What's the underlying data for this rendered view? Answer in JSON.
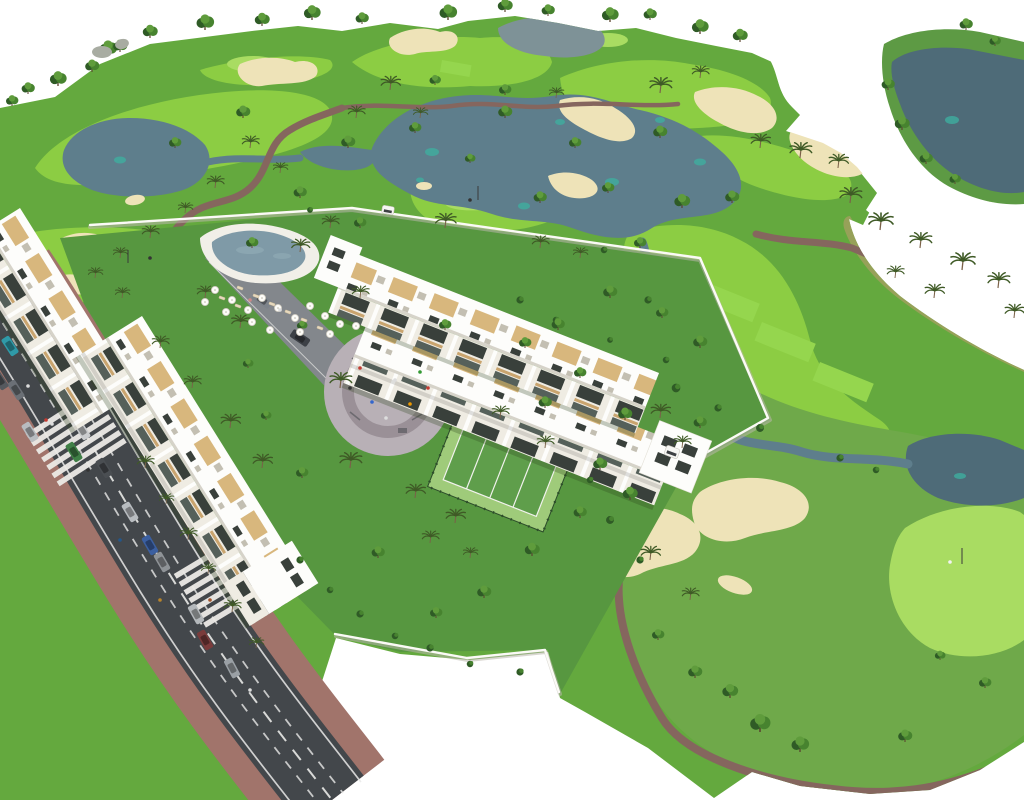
{
  "palette": {
    "bg": "#ffffff",
    "rough": "#64a93e",
    "fringe": "#5d9a44",
    "fairway": "#8ccd43",
    "fairwayMuted": "#6fa94a",
    "green": "#a9dc62",
    "tee": "#95d64e",
    "lake": "#5e7e8c",
    "lakeDark": "#4e6b78",
    "pond": "#7e9297",
    "lakeSpot": "#3fae9f",
    "bunker": "#eee3b8",
    "path": "#85665e",
    "scrub": "#97a159",
    "scrubSpeckle": "#cbca7a",
    "scrubSpeckleDark": "#7e8c4e",
    "lawn": "#579740",
    "building": "#fdfdfb",
    "facade": "#efece3",
    "window": "#39403b",
    "windowLow": "#55605a",
    "wood": "#c9a46e",
    "pergola": "#d8b77d",
    "parapet": "#d6d3c9",
    "roofGray": "#c3bfb2",
    "road": "#43474b",
    "roadLine": "#e9e9e7",
    "sidewalk": "#a1746b",
    "plaza": "#b8b0b6",
    "plazaRing": "#9a9097",
    "pool": "#7f9aa7",
    "poolDeck": "#f1efe8",
    "court": "#9fcb7a",
    "courtIn": "#5f9e4b",
    "courtFence": "#2c4c2a",
    "wall": "#fbfaf6",
    "wallShadow": "#b9b6ac",
    "treeDark": "#2f5b26",
    "treeMid": "#47832f",
    "treeLight": "#5f9c3c",
    "trunk": "#5b4630",
    "palmLeaf": "#3f5a26",
    "palmTrunk": "#7a6148",
    "rock": "#a8aca2",
    "shadow": "#2c4218",
    "driveway": "#83878c",
    "cartWhite": "#f6f6f3"
  },
  "scene": {
    "trees": [
      [
        108,
        56,
        1
      ],
      [
        150,
        38,
        0.85
      ],
      [
        205,
        30,
        1
      ],
      [
        262,
        26,
        0.85
      ],
      [
        312,
        20,
        0.95
      ],
      [
        362,
        24,
        0.75
      ],
      [
        448,
        20,
        1
      ],
      [
        505,
        12,
        0.85
      ],
      [
        548,
        16,
        0.75
      ],
      [
        610,
        22,
        0.95
      ],
      [
        650,
        20,
        0.75
      ],
      [
        700,
        34,
        0.95
      ],
      [
        740,
        42,
        0.85
      ],
      [
        92,
        72,
        0.8
      ],
      [
        58,
        86,
        0.95
      ],
      [
        28,
        94,
        0.75
      ],
      [
        12,
        106,
        0.7
      ],
      [
        120,
        52,
        0.8
      ],
      [
        243,
        118,
        0.8
      ],
      [
        175,
        148,
        0.7
      ],
      [
        348,
        148,
        0.8
      ],
      [
        415,
        133,
        0.7
      ],
      [
        505,
        118,
        0.8
      ],
      [
        575,
        148,
        0.7
      ],
      [
        660,
        138,
        0.8
      ],
      [
        608,
        193,
        0.7
      ],
      [
        540,
        203,
        0.75
      ],
      [
        470,
        163,
        0.6
      ],
      [
        300,
        198,
        0.75
      ],
      [
        360,
        228,
        0.7
      ],
      [
        252,
        248,
        0.7
      ],
      [
        682,
        208,
        0.9
      ],
      [
        732,
        203,
        0.8
      ],
      [
        640,
        248,
        0.7
      ],
      [
        610,
        298,
        0.8
      ],
      [
        662,
        318,
        0.7
      ],
      [
        700,
        348,
        0.8
      ],
      [
        580,
        378,
        0.7
      ],
      [
        545,
        408,
        0.75
      ],
      [
        625,
        420,
        0.8
      ],
      [
        505,
        95,
        0.7
      ],
      [
        435,
        85,
        0.65
      ],
      [
        888,
        90,
        0.75
      ],
      [
        902,
        130,
        0.85
      ],
      [
        926,
        164,
        0.75
      ],
      [
        955,
        184,
        0.65
      ],
      [
        966,
        30,
        0.75
      ],
      [
        995,
        46,
        0.65
      ],
      [
        760,
        732,
        1.15
      ],
      [
        800,
        752,
        1
      ],
      [
        730,
        698,
        0.9
      ],
      [
        695,
        678,
        0.8
      ],
      [
        905,
        742,
        0.8
      ],
      [
        658,
        640,
        0.7
      ],
      [
        985,
        688,
        0.7
      ],
      [
        940,
        660,
        0.6
      ],
      [
        600,
        470,
        0.8
      ],
      [
        630,
        500,
        0.85
      ],
      [
        580,
        518,
        0.75
      ],
      [
        532,
        556,
        0.85
      ],
      [
        484,
        598,
        0.8
      ],
      [
        436,
        618,
        0.7
      ],
      [
        378,
        558,
        0.75
      ],
      [
        302,
        478,
        0.7
      ],
      [
        266,
        420,
        0.6
      ],
      [
        700,
        428,
        0.75
      ],
      [
        525,
        348,
        0.7
      ],
      [
        558,
        330,
        0.75
      ],
      [
        445,
        330,
        0.7
      ],
      [
        302,
        330,
        0.6
      ],
      [
        248,
        368,
        0.6
      ]
    ],
    "palms": [
      [
        390,
        90,
        0.8
      ],
      [
        356,
        118,
        0.7
      ],
      [
        420,
        118,
        0.6
      ],
      [
        660,
        93,
        0.9
      ],
      [
        700,
        78,
        0.7
      ],
      [
        556,
        98,
        0.6
      ],
      [
        760,
        148,
        0.8
      ],
      [
        800,
        158,
        0.9
      ],
      [
        838,
        168,
        0.8
      ],
      [
        850,
        203,
        0.9
      ],
      [
        250,
        148,
        0.7
      ],
      [
        280,
        173,
        0.6
      ],
      [
        215,
        188,
        0.7
      ],
      [
        185,
        213,
        0.6
      ],
      [
        150,
        238,
        0.7
      ],
      [
        120,
        258,
        0.6
      ],
      [
        95,
        278,
        0.6
      ],
      [
        540,
        248,
        0.7
      ],
      [
        580,
        258,
        0.6
      ],
      [
        880,
        230,
        1
      ],
      [
        920,
        248,
        0.9
      ],
      [
        962,
        270,
        1
      ],
      [
        998,
        288,
        0.9
      ],
      [
        1014,
        318,
        0.8
      ],
      [
        934,
        298,
        0.8
      ],
      [
        895,
        278,
        0.7
      ],
      [
        340,
        388,
        0.9
      ],
      [
        350,
        468,
        0.9
      ],
      [
        415,
        498,
        0.8
      ],
      [
        455,
        523,
        0.8
      ],
      [
        500,
        418,
        0.7
      ],
      [
        545,
        448,
        0.7
      ],
      [
        230,
        428,
        0.8
      ],
      [
        262,
        468,
        0.8
      ],
      [
        160,
        348,
        0.7
      ],
      [
        192,
        388,
        0.7
      ],
      [
        122,
        298,
        0.6
      ],
      [
        430,
        543,
        0.7
      ],
      [
        470,
        558,
        0.6
      ],
      [
        660,
        418,
        0.8
      ],
      [
        682,
        448,
        0.7
      ],
      [
        145,
        468,
        0.7
      ],
      [
        166,
        504,
        0.6
      ],
      [
        188,
        540,
        0.7
      ],
      [
        208,
        574,
        0.6
      ],
      [
        232,
        612,
        0.7
      ],
      [
        256,
        648,
        0.6
      ],
      [
        445,
        228,
        0.85
      ],
      [
        300,
        252,
        0.75
      ],
      [
        360,
        298,
        0.7
      ],
      [
        205,
        298,
        0.7
      ],
      [
        240,
        328,
        0.75
      ],
      [
        330,
        228,
        0.7
      ],
      [
        650,
        560,
        0.8
      ],
      [
        690,
        600,
        0.7
      ]
    ],
    "bushes": [
      [
        648,
        300,
        1
      ],
      [
        676,
        388,
        1.2
      ],
      [
        718,
        408,
        1
      ],
      [
        760,
        428,
        1.1
      ],
      [
        840,
        458,
        1
      ],
      [
        876,
        470,
        0.9
      ],
      [
        604,
        250,
        0.9
      ],
      [
        310,
        210,
        0.8
      ],
      [
        520,
        300,
        1
      ],
      [
        556,
        320,
        0.9
      ],
      [
        610,
        340,
        0.8
      ],
      [
        666,
        360,
        0.9
      ],
      [
        300,
        560,
        1
      ],
      [
        330,
        590,
        0.9
      ],
      [
        360,
        614,
        1
      ],
      [
        395,
        636,
        0.9
      ],
      [
        430,
        648,
        1
      ],
      [
        470,
        664,
        0.9
      ],
      [
        520,
        672,
        1
      ],
      [
        610,
        520,
        1.1
      ],
      [
        640,
        560,
        1
      ],
      [
        590,
        480,
        0.9
      ]
    ],
    "umbrellas": [
      [
        215,
        290
      ],
      [
        232,
        300
      ],
      [
        248,
        310
      ],
      [
        262,
        298
      ],
      [
        278,
        308
      ],
      [
        295,
        318
      ],
      [
        310,
        306
      ],
      [
        325,
        316
      ],
      [
        340,
        324
      ],
      [
        252,
        322
      ],
      [
        270,
        330
      ],
      [
        300,
        332
      ],
      [
        330,
        334
      ],
      [
        356,
        326
      ],
      [
        226,
        312
      ],
      [
        205,
        302
      ]
    ],
    "loungers": [
      [
        240,
        288,
        20
      ],
      [
        256,
        296,
        20
      ],
      [
        272,
        304,
        20
      ],
      [
        288,
        312,
        20
      ],
      [
        304,
        320,
        20
      ],
      [
        320,
        328,
        20
      ],
      [
        238,
        306,
        20
      ],
      [
        222,
        298,
        20
      ]
    ],
    "cars": [
      [
        36,
        348,
        57,
        "#b8bcc0"
      ],
      [
        58,
        388,
        57,
        "#9aa0a5"
      ],
      [
        82,
        430,
        58,
        "#caccce"
      ],
      [
        104,
        468,
        58,
        "#4a4e52"
      ],
      [
        130,
        512,
        59,
        "#b8bcc0"
      ],
      [
        162,
        562,
        60,
        "#8f9397"
      ],
      [
        196,
        614,
        61,
        "#b4b8bb"
      ],
      [
        232,
        668,
        62,
        "#9aa0a5"
      ],
      [
        10,
        346,
        57,
        "#2f9aa8"
      ],
      [
        16,
        390,
        57,
        "#6b7076"
      ],
      [
        30,
        432,
        58,
        "#b8bcc0"
      ],
      [
        74,
        452,
        58,
        "#3f7f46"
      ],
      [
        0,
        380,
        57,
        "#55595e"
      ],
      [
        150,
        545,
        60,
        "#3b5fa0"
      ],
      [
        205,
        640,
        61,
        "#7a3b3b"
      ],
      [
        262,
        300,
        34,
        "#7d838a"
      ],
      [
        300,
        338,
        34,
        "#3c4046"
      ]
    ],
    "people": [
      [
        46,
        420,
        "#c23b32"
      ],
      [
        52,
        424,
        "#dddddd"
      ],
      [
        120,
        540,
        "#24568a"
      ],
      [
        210,
        600,
        "#a2542c"
      ],
      [
        250,
        690,
        "#dddddd"
      ],
      [
        88,
        470,
        "#333333"
      ],
      [
        160,
        600,
        "#b8842c"
      ],
      [
        28,
        386,
        "#dddddd"
      ],
      [
        360,
        368,
        "#c23b32"
      ],
      [
        395,
        380,
        "#dddddd"
      ],
      [
        372,
        402,
        "#3366cc"
      ],
      [
        410,
        404,
        "#ee9900"
      ],
      [
        350,
        388,
        "#333333"
      ],
      [
        428,
        388,
        "#c23b32"
      ],
      [
        386,
        418,
        "#dddddd"
      ],
      [
        420,
        372,
        "#339933"
      ],
      [
        250,
        300,
        "#cc8888"
      ],
      [
        280,
        310,
        "#dddddd"
      ],
      [
        470,
        200,
        "#333333"
      ],
      [
        150,
        258,
        "#333333"
      ],
      [
        950,
        562,
        "#f2f2f2"
      ]
    ],
    "lakeSpots": [
      [
        432,
        152,
        7,
        4
      ],
      [
        524,
        206,
        6,
        3.5
      ],
      [
        612,
        182,
        7,
        4
      ],
      [
        700,
        162,
        6,
        3.5
      ],
      [
        560,
        122,
        5,
        3
      ],
      [
        120,
        160,
        6,
        3.5
      ],
      [
        952,
        120,
        7,
        4
      ],
      [
        960,
        476,
        6,
        3
      ],
      [
        660,
        120,
        5,
        3
      ],
      [
        420,
        180,
        4,
        2.5
      ]
    ],
    "scrubDots": [
      [
        870,
        240
      ],
      [
        890,
        252
      ],
      [
        912,
        266
      ],
      [
        934,
        280
      ],
      [
        958,
        292
      ],
      [
        980,
        304
      ],
      [
        1002,
        316
      ],
      [
        880,
        262
      ],
      [
        905,
        278
      ],
      [
        930,
        292
      ],
      [
        955,
        306
      ],
      [
        978,
        320
      ],
      [
        1000,
        332
      ],
      [
        862,
        230
      ]
    ],
    "crosswalks": [
      [
        76,
        438,
        57
      ],
      [
        224,
        580,
        59
      ]
    ]
  }
}
